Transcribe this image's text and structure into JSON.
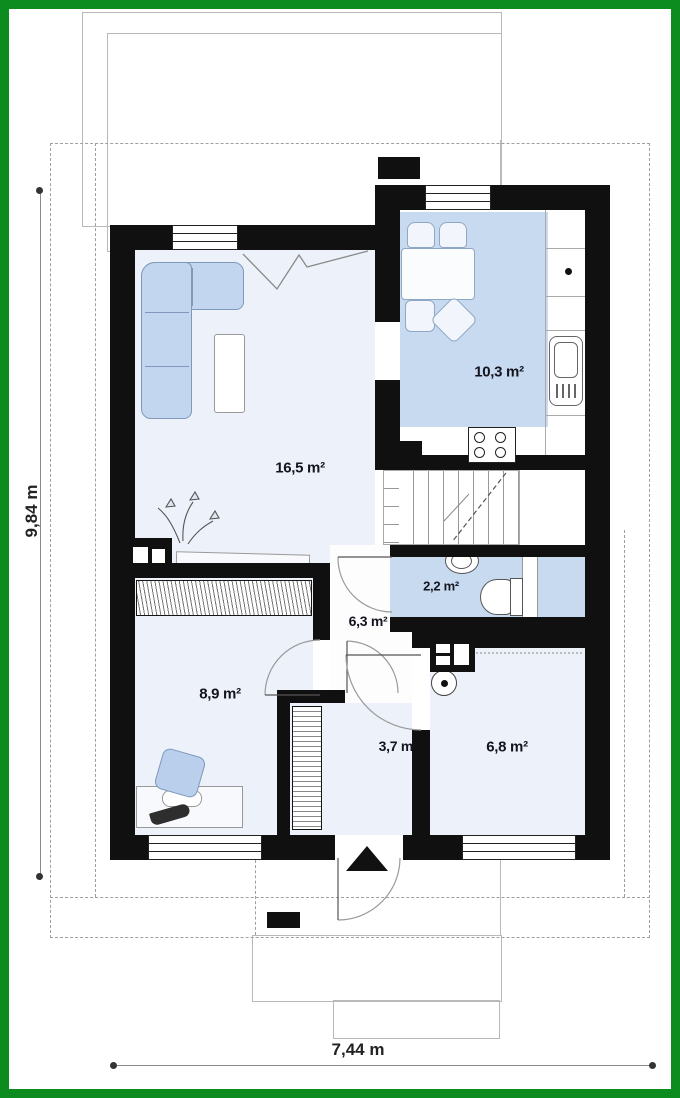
{
  "plan": {
    "title": "single-storey house floor plan",
    "rooms": [
      {
        "name": "living-room",
        "area": "16,5 m²"
      },
      {
        "name": "kitchen",
        "area": "10,3 m²"
      },
      {
        "name": "wc",
        "area": "2,2 m²"
      },
      {
        "name": "hallway",
        "area": "6,3 m²"
      },
      {
        "name": "bedroom",
        "area": "8,9 m²"
      },
      {
        "name": "vestibule",
        "area": "3,7 m²"
      },
      {
        "name": "utility-room",
        "area": "6,8 m²"
      }
    ],
    "dimensions": {
      "height": "9,84 m",
      "width": "7,44 m"
    },
    "colors": {
      "border_green": "#0c8b1e",
      "wall_black": "#101010",
      "room_fill_light": "#edf1f9",
      "room_fill_blue": "#c7daef",
      "furniture_blue": "#c3d6ef",
      "outline_gray": "#b9b9b9"
    }
  }
}
